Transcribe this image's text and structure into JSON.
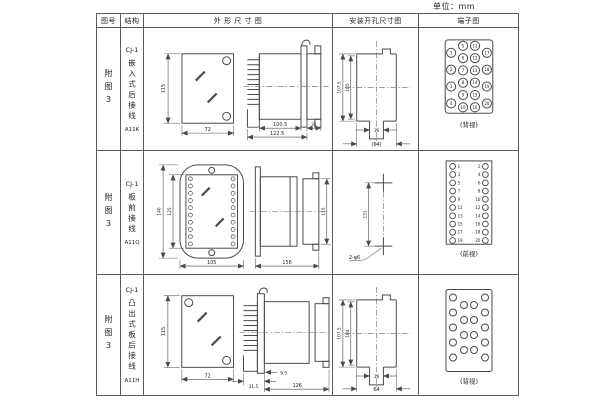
{
  "unit_label": "单位：mm",
  "header": {
    "fig": "图号",
    "struct": "结构",
    "outline": "外 形 尺 寸 图",
    "mounting": "安装开孔尺寸图",
    "terminal": "端子图"
  },
  "rows": [
    {
      "fig": "附图3",
      "model": "CJ-1",
      "desc": "嵌入式后接线",
      "code": "A11K",
      "outline": {
        "height": "115",
        "width": "72",
        "body": "100.5",
        "overall": "122.5",
        "cap": "35"
      },
      "mounting": {
        "outer": "107.5",
        "inner": "105",
        "slot": "16",
        "width": "(64)"
      },
      "terminal": {
        "caption": "(背视)",
        "outer_left": [
          "1",
          "2",
          "3",
          "4"
        ],
        "inner_left": [
          "5",
          "6",
          "7",
          "8",
          "9",
          "10"
        ],
        "inner_right": [
          "11",
          "12",
          "13",
          "14",
          "15",
          "16"
        ],
        "outer_right": [
          "17",
          "18",
          "19",
          "20"
        ]
      }
    },
    {
      "fig": "附图3",
      "model": "CJ-1",
      "desc": "板前接线",
      "code": "A11Q",
      "outline": {
        "outer_h": "140",
        "inner_h": "125",
        "width": "105",
        "side_len": "156",
        "side_h": "115"
      },
      "mounting": {
        "pitch": "131",
        "hole": "2-φ6"
      },
      "terminal": {
        "caption": "(前视)",
        "left": [
          "1",
          "3",
          "5",
          "7",
          "9",
          "11",
          "13",
          "15",
          "17",
          "19"
        ],
        "right": [
          "2",
          "4",
          "6",
          "8",
          "10",
          "12",
          "14",
          "16",
          "18",
          "20"
        ]
      }
    },
    {
      "fig": "附图3",
      "model": "CJ-1",
      "desc": "凸出式板后接线",
      "code": "A11H",
      "outline": {
        "height": "115",
        "width": "72",
        "teeth": "31.5",
        "offset": "9.5",
        "body": "126"
      },
      "mounting": {
        "outer": "107.5",
        "inner": "104",
        "slot": "16",
        "width": "64"
      },
      "terminal": {
        "caption": "(背视)"
      }
    }
  ]
}
